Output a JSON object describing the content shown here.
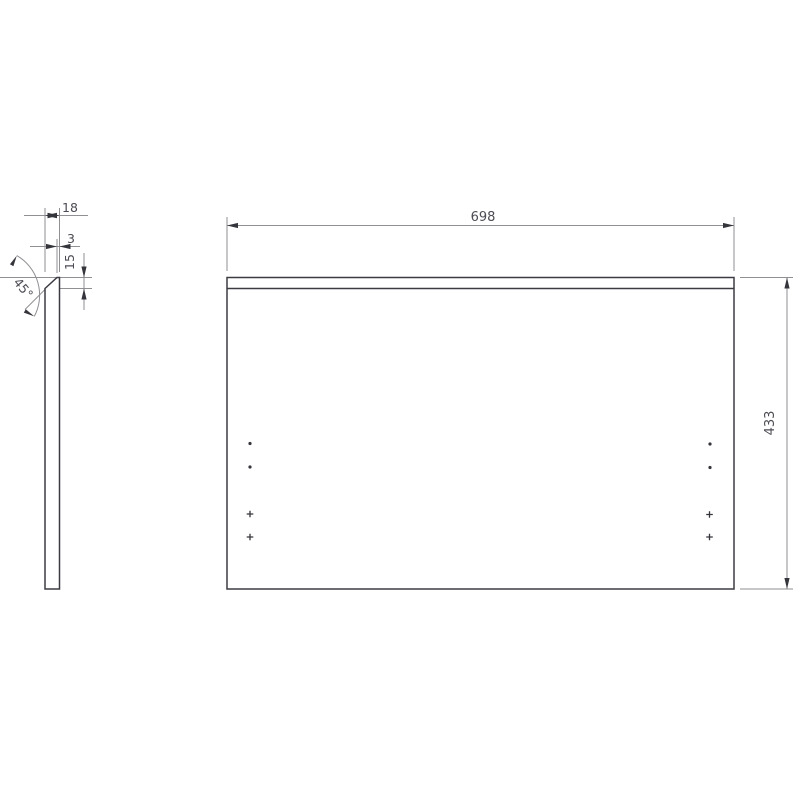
{
  "dimensions": {
    "panel_width": "698",
    "panel_height": "433",
    "panel_thickness": "18",
    "top_edge_flat": "3",
    "chamfer_depth": "15",
    "chamfer_angle": "45°"
  },
  "colors": {
    "background": "#ffffff",
    "edge": "#3b3b42",
    "dimension_line": "#8f8f94",
    "arrow": "#35353c",
    "text": "#4c4c54"
  },
  "hole_marks": {
    "dots": [
      {
        "x": 250,
        "y": 443.5
      },
      {
        "x": 250,
        "y": 467
      },
      {
        "x": 710,
        "y": 444
      },
      {
        "x": 710,
        "y": 467.5
      }
    ],
    "crosses": [
      {
        "x": 250,
        "y": 514
      },
      {
        "x": 250,
        "y": 537
      },
      {
        "x": 709.5,
        "y": 514.5
      },
      {
        "x": 709.5,
        "y": 537
      }
    ]
  }
}
